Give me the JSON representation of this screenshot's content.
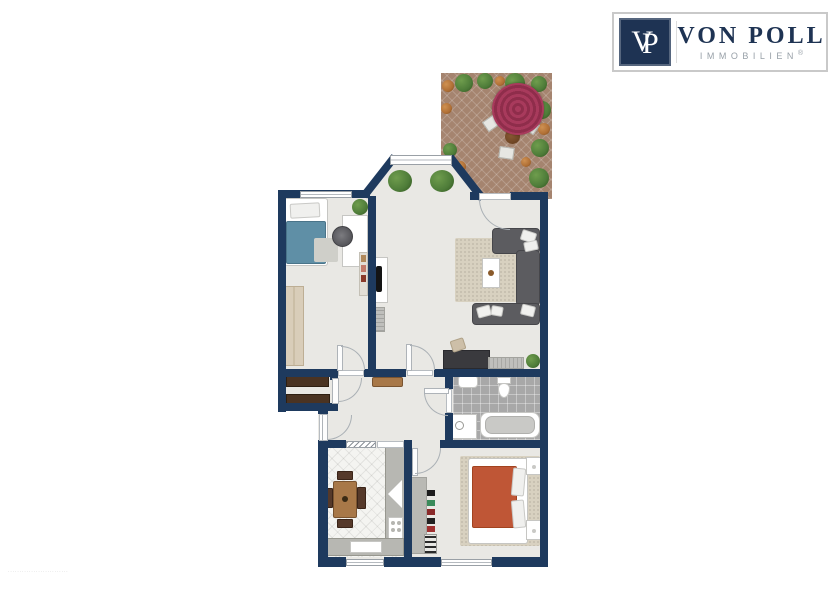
{
  "logo": {
    "monogram_v": "V",
    "monogram_p": "P",
    "brand": "VON POLL",
    "subtitle": "IMMOBILIEN",
    "registered_mark": "®"
  },
  "watermark": "··························",
  "regions": [
    "terrace",
    "living-room",
    "bedroom-office",
    "hallway",
    "storage-niche",
    "bathroom",
    "kitchen",
    "master-bedroom"
  ],
  "icons": [
    "parasol-icon",
    "plant-icon",
    "bed-icon",
    "sofa-icon",
    "bathtub-icon",
    "toilet-icon",
    "sink-icon",
    "washing-machine-icon",
    "dining-table-icon",
    "stove-icon",
    "tv-icon",
    "office-chair-icon",
    "door-swing-icon",
    "window-icon"
  ],
  "colors": {
    "wall": "#1e3a5e",
    "floor": "#e9e8e4",
    "bathfloor": "#a8a8a8",
    "kitfloor": "#f4f4f1",
    "terrace": "#a5846f",
    "rug": "#d8d1c0",
    "sofa": "#5c5c60",
    "wood": "#a87848",
    "wooddk": "#55392a",
    "shelfdk": "#4a3322",
    "counter": "#b7b7b2",
    "bedblue": "#5f8fa6",
    "bedorange": "#bf5636",
    "parasol": "#a83a5c",
    "parasoldk": "#8f2d4b",
    "plant": "#4e7c39",
    "plantor": "#b06f35",
    "navy": "#1e3353",
    "graytext": "#98a0a8",
    "border": "#c9c9c9"
  }
}
